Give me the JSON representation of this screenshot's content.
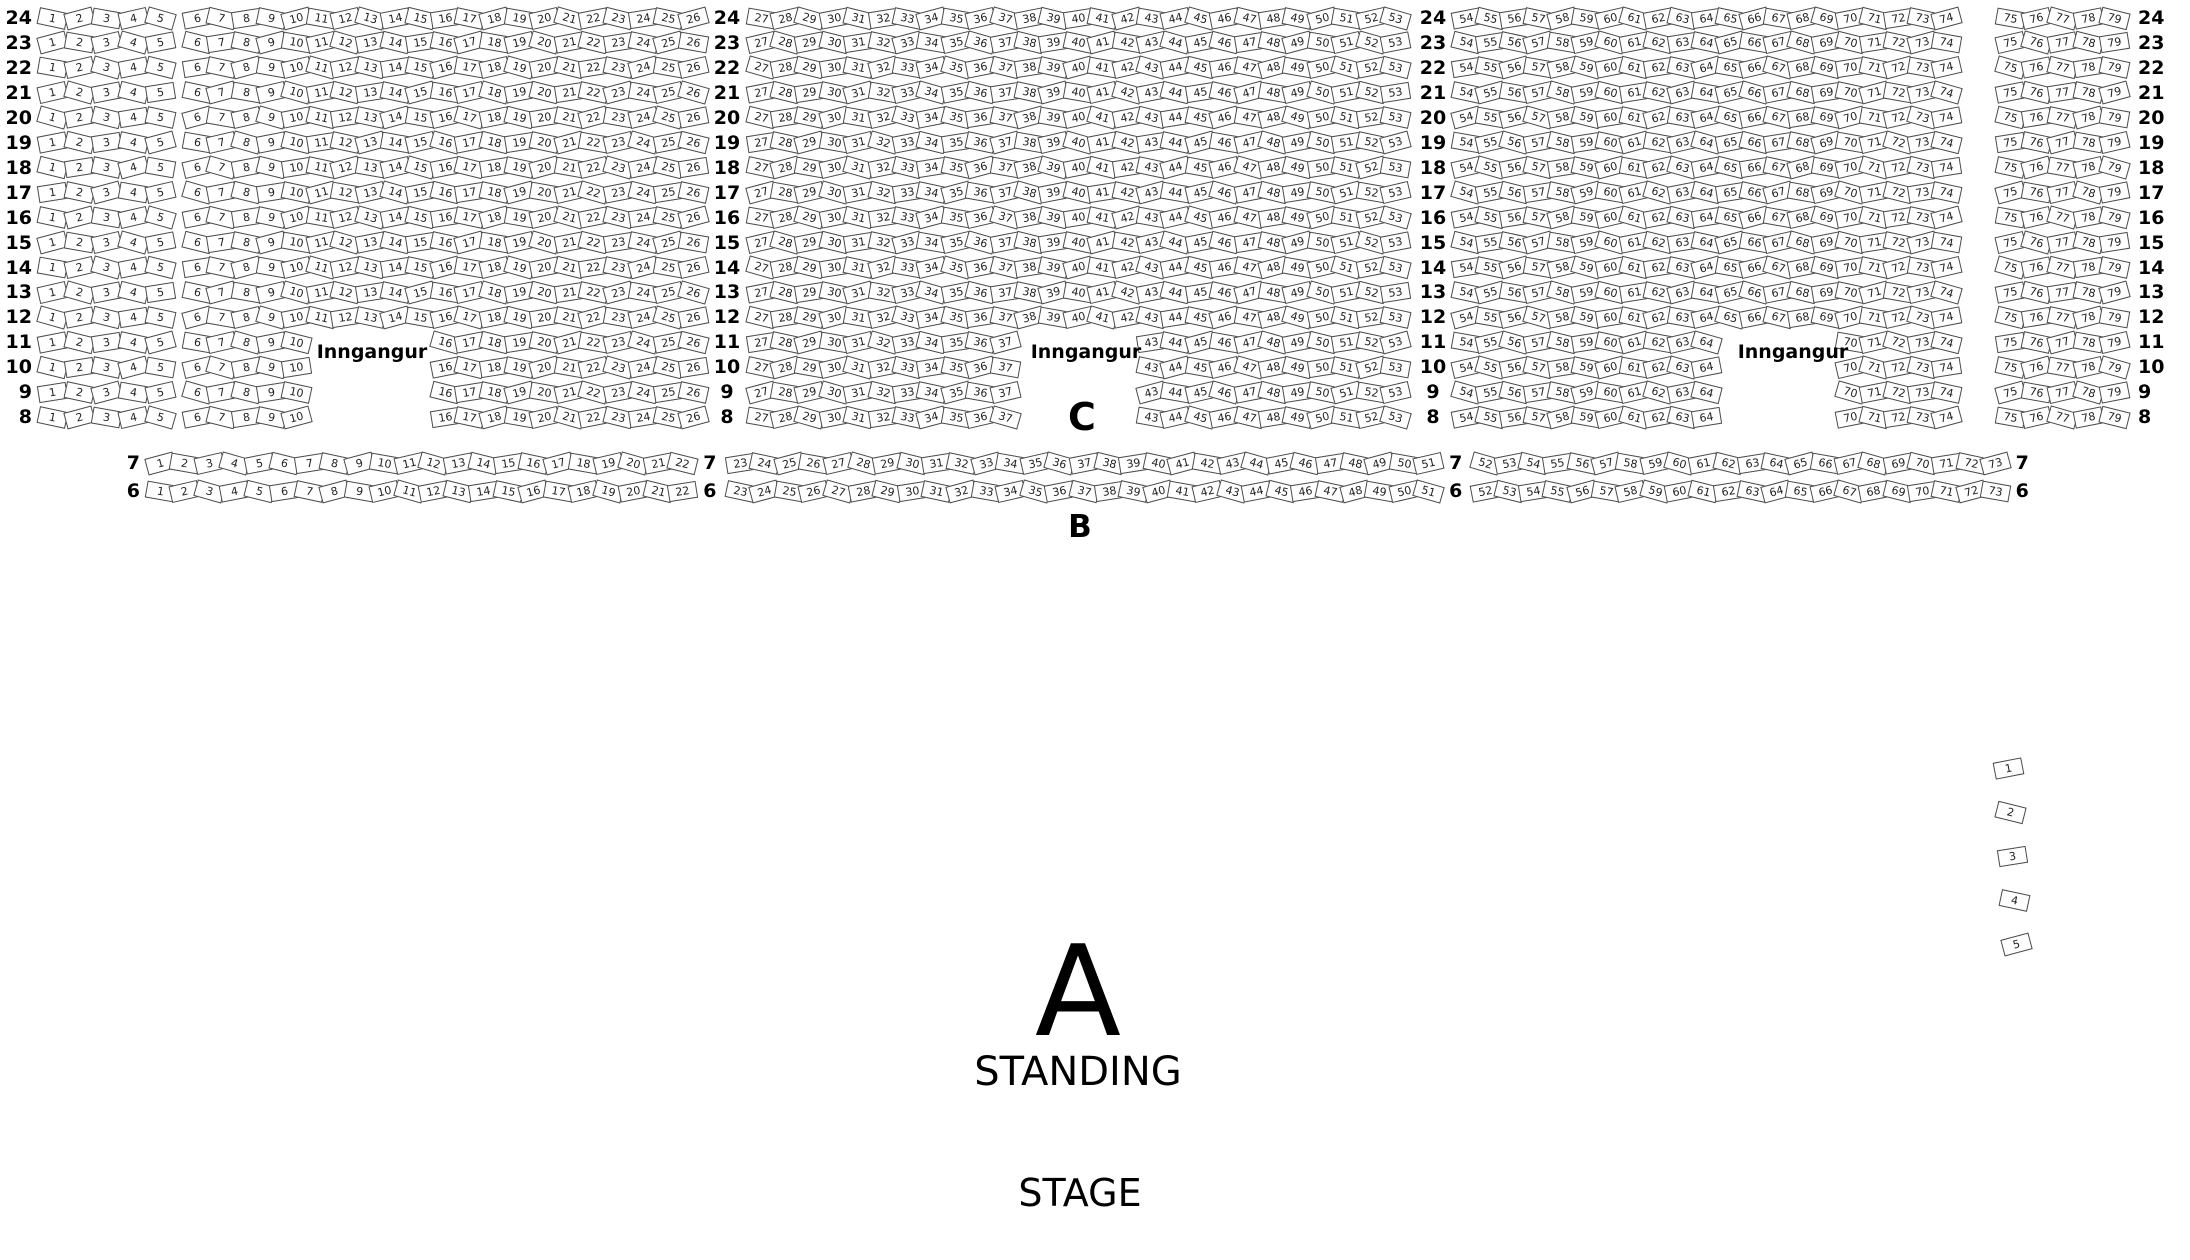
{
  "venue_map": {
    "entrance_label": "Inngangur",
    "sections": {
      "c": {
        "label": "C",
        "row_numbers": [
          24,
          23,
          22,
          21,
          20,
          19,
          18,
          17,
          16,
          15,
          14,
          13,
          12,
          11,
          10,
          9,
          8
        ],
        "full_rows": [
          24,
          23,
          22,
          21,
          20,
          19,
          18,
          17,
          16,
          15,
          14,
          13,
          12
        ],
        "gapped_rows": [
          11,
          10,
          9,
          8
        ],
        "full_row_blocks": [
          [
            1,
            5
          ],
          [
            6,
            26
          ],
          [
            27,
            53
          ],
          [
            54,
            74
          ],
          [
            75,
            79
          ]
        ],
        "gapped_row_blocks": [
          [
            1,
            5
          ],
          [
            6,
            10
          ],
          [
            16,
            26
          ],
          [
            27,
            37
          ],
          [
            43,
            53
          ],
          [
            54,
            64
          ],
          [
            70,
            74
          ],
          [
            75,
            79
          ]
        ]
      },
      "b": {
        "label": "B",
        "row_numbers": [
          7,
          6
        ],
        "seat_range": [
          1,
          73
        ],
        "row_label_breaks_after_seats": [
          22,
          51,
          73
        ]
      },
      "a": {
        "label": "A",
        "sublabel": "STANDING"
      }
    },
    "stage_label": "STAGE",
    "side_seats": [
      1,
      2,
      3,
      4,
      5
    ],
    "colors": {
      "background": "#ffffff",
      "seat_fill": "#ffffff",
      "seat_border": "#4a4a4a",
      "seat_number": "#222222",
      "label_text": "#000000"
    }
  }
}
